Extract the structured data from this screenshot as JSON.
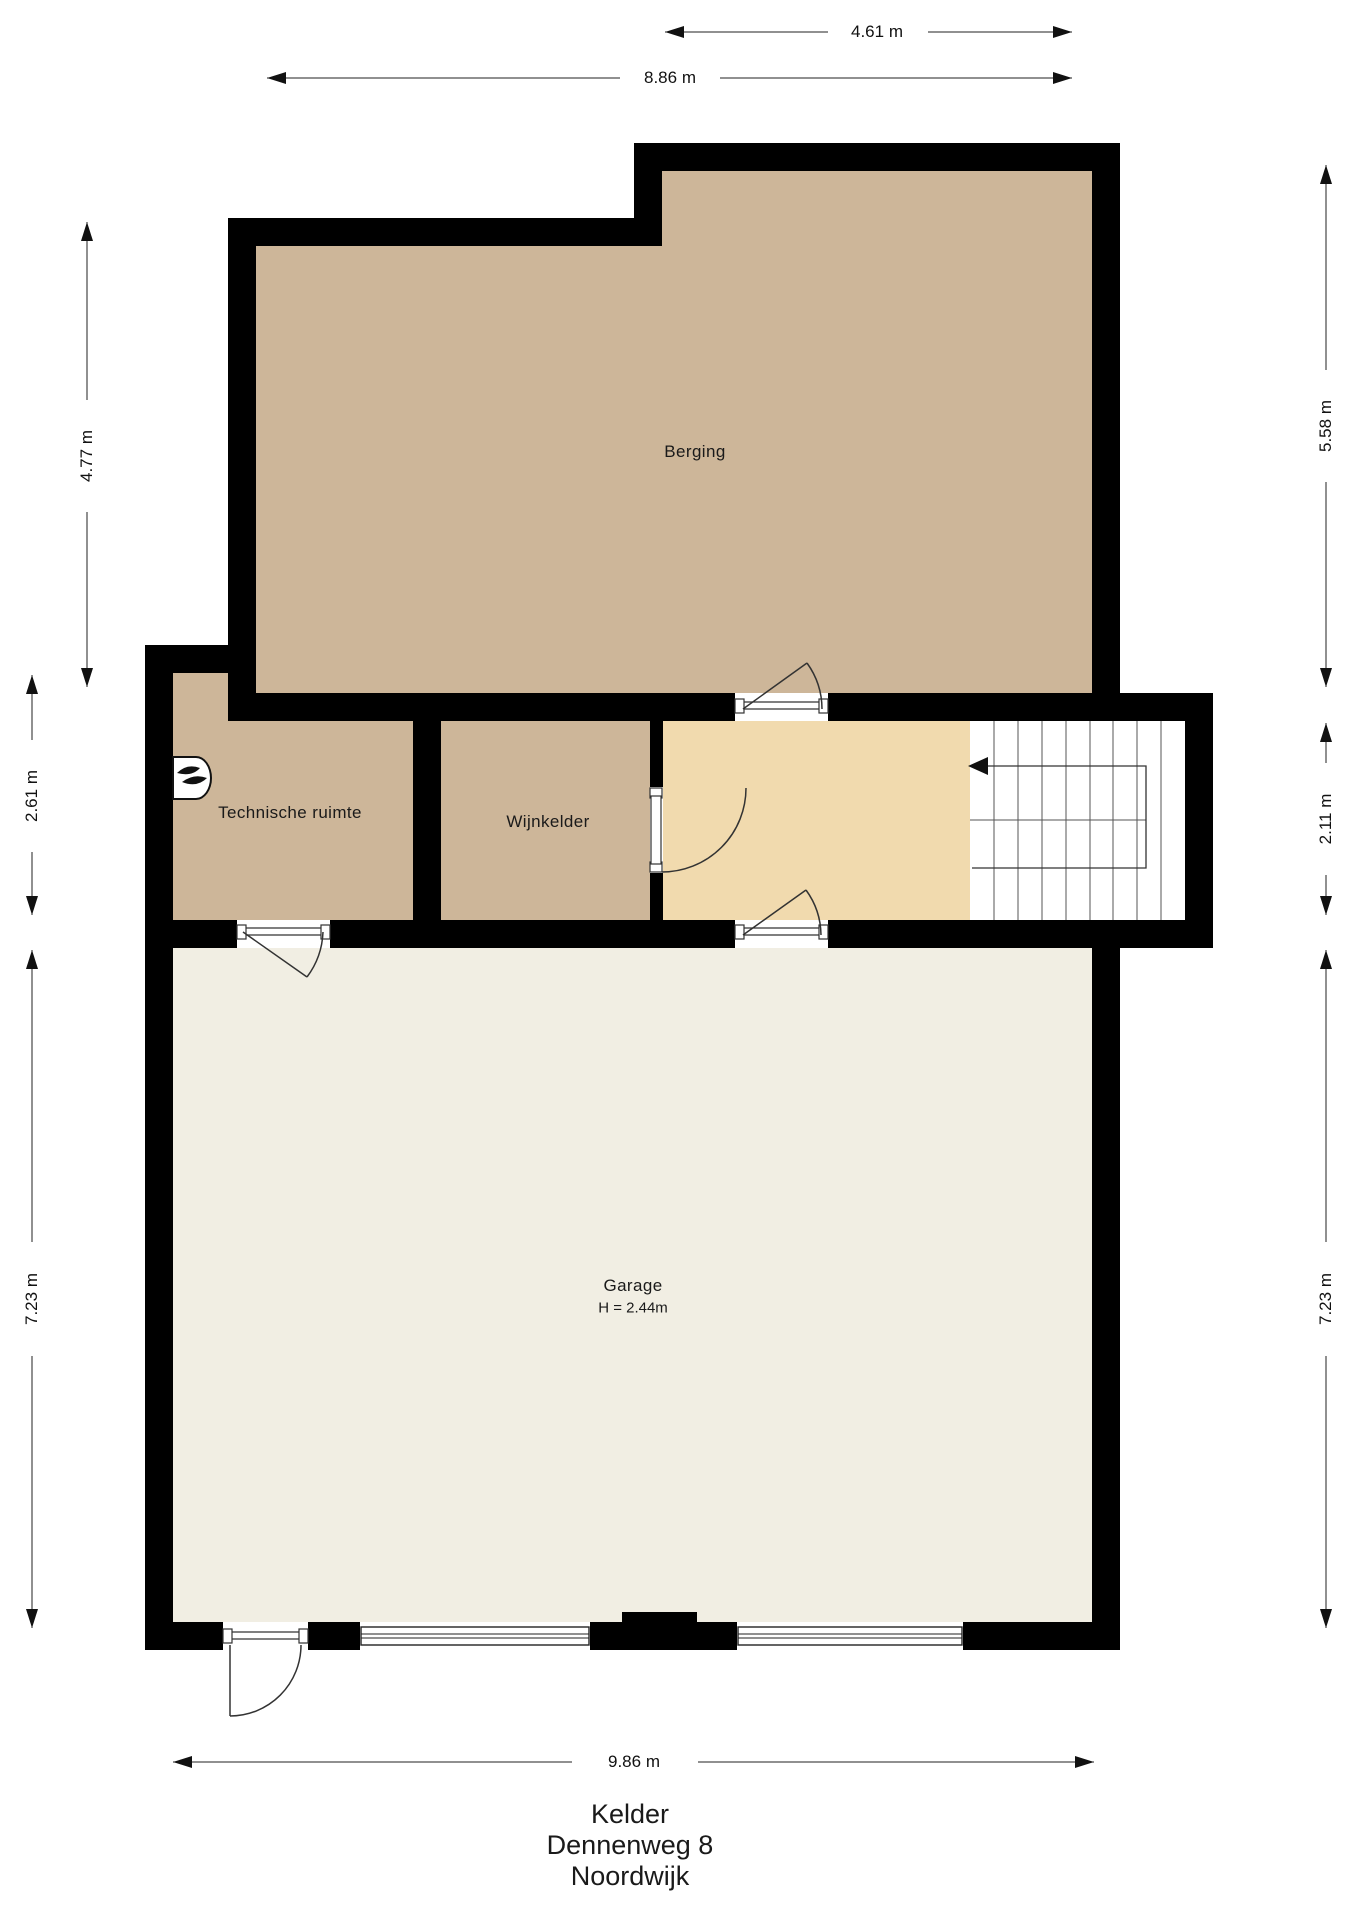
{
  "title_block": {
    "floor": "Kelder",
    "address": "Dennenweg 8",
    "city": "Noordwijk"
  },
  "rooms": {
    "berging": {
      "label": "Berging"
    },
    "technische_ruimte": {
      "label": "Technische ruimte"
    },
    "wijnkelder": {
      "label": "Wijnkelder"
    },
    "garage": {
      "label": "Garage",
      "height_note": "H = 2.44m"
    }
  },
  "dimensions": {
    "top_partial": "4.61 m",
    "top_full": "8.86 m",
    "left_upper": "4.77 m",
    "left_middle": "2.61 m",
    "left_lower": "7.23 m",
    "right_upper": "5.58 m",
    "right_middle": "2.11 m",
    "right_lower": "7.23 m",
    "bottom": "9.86 m"
  },
  "icons": {
    "boiler": "flame-icon",
    "stairs_direction": "arrow-left-icon"
  },
  "colors": {
    "wall": "#000000",
    "room_tan": "#CDB699",
    "room_beige": "#F1DAAE",
    "room_cream": "#F1EEE3"
  }
}
